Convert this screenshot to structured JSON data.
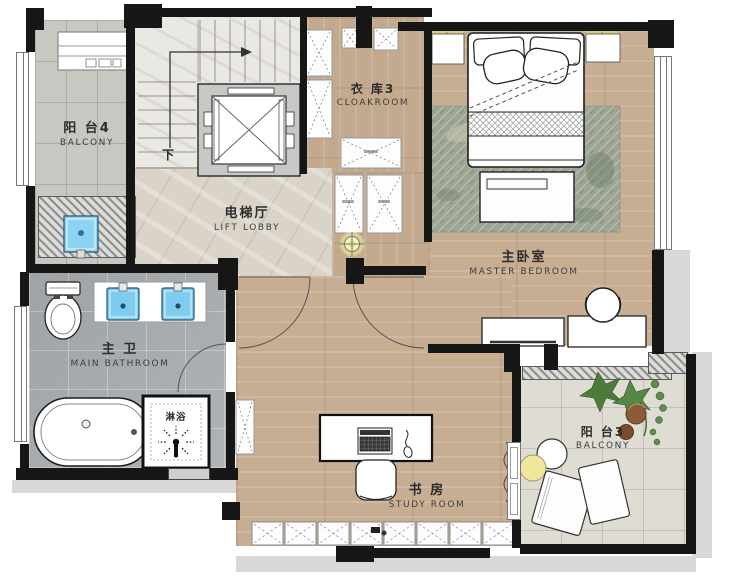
{
  "rooms": {
    "balcony4": {
      "name_cn": "阳 台4",
      "name_en": "BALCONY"
    },
    "cloakroom3": {
      "name_cn": "衣 库3",
      "name_en": "CLOAKROOM"
    },
    "lift_lobby": {
      "name_cn": "电梯厅",
      "name_en": "LIFT LOBBY"
    },
    "master_bedroom": {
      "name_cn": "主卧室",
      "name_en": "MASTER BEDROOM"
    },
    "main_bathroom": {
      "name_cn": "主 卫",
      "name_en": "MAIN BATHROOM"
    },
    "study_room": {
      "name_cn": "书 房",
      "name_en": "STUDY ROOM"
    },
    "balcony3": {
      "name_cn": "阳 台3",
      "name_en": "BALCONY"
    }
  },
  "annotations": {
    "shower_cn": "淋浴",
    "stairs_down_cn": "下"
  },
  "palette": {
    "wall": "#161616",
    "wood_floor": "#c7ad92",
    "bath_tile": "#a9adb0",
    "lobby_floor": "#d9d3c8",
    "balcony_tile": "#dedcd3",
    "rug_green": "#9da694",
    "fixture_blue": "#7fccee",
    "light_yellow": "#efe98f",
    "plant_green": "#4c7b3b",
    "pot_brown": "#8a5b36"
  }
}
